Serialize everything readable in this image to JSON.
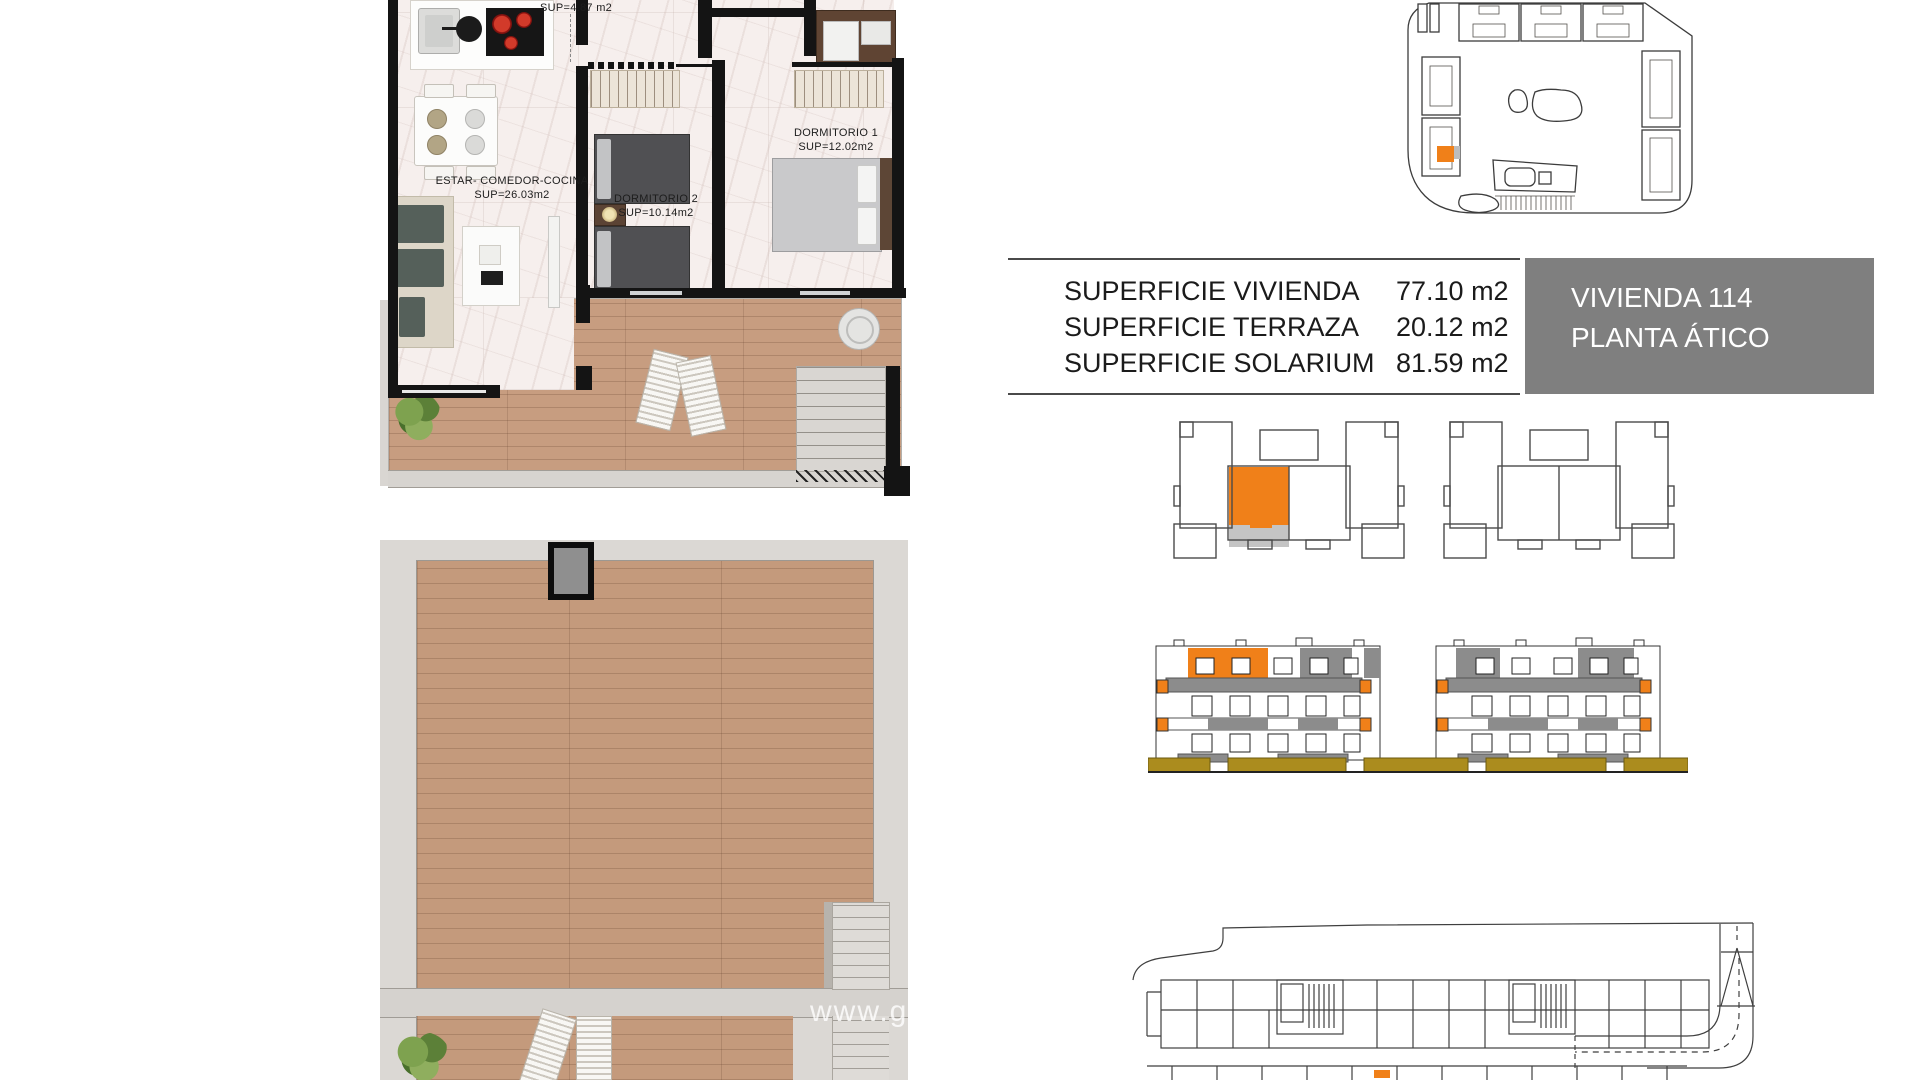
{
  "page": {
    "background": "#ffffff",
    "watermark": "www.go"
  },
  "apartment_plan": {
    "labels": {
      "bath_sup": "SUP=4.87 m2",
      "living_name": "ESTAR- COMEDOR-COCINA",
      "living_sup": "SUP=26.03m2",
      "bedroom2_name": "DORMITORIO 2",
      "bedroom2_sup": "SUP=10.14m2",
      "bedroom1_name": "DORMITORIO 1",
      "bedroom1_sup": "SUP=12.02m2"
    }
  },
  "surface_table": {
    "rows": [
      {
        "label": "SUPERFICIE VIVIENDA",
        "value": "77.10 m2"
      },
      {
        "label": "SUPERFICIE TERRAZA",
        "value": "20.12 m2"
      },
      {
        "label": "SUPERFICIE SOLARIUM",
        "value": "81.59 m2"
      }
    ]
  },
  "unit_box": {
    "line1": "VIVIENDA 114",
    "line2": "PLANTA ÁTICO"
  },
  "colors": {
    "highlight_orange": "#F08019",
    "unit_box_gray": "#7F7F7F",
    "elevation_gray": "#8C8C8C",
    "key_terrace_gray": "#C4C4C4",
    "planter_olive": "#AB8C1E"
  }
}
